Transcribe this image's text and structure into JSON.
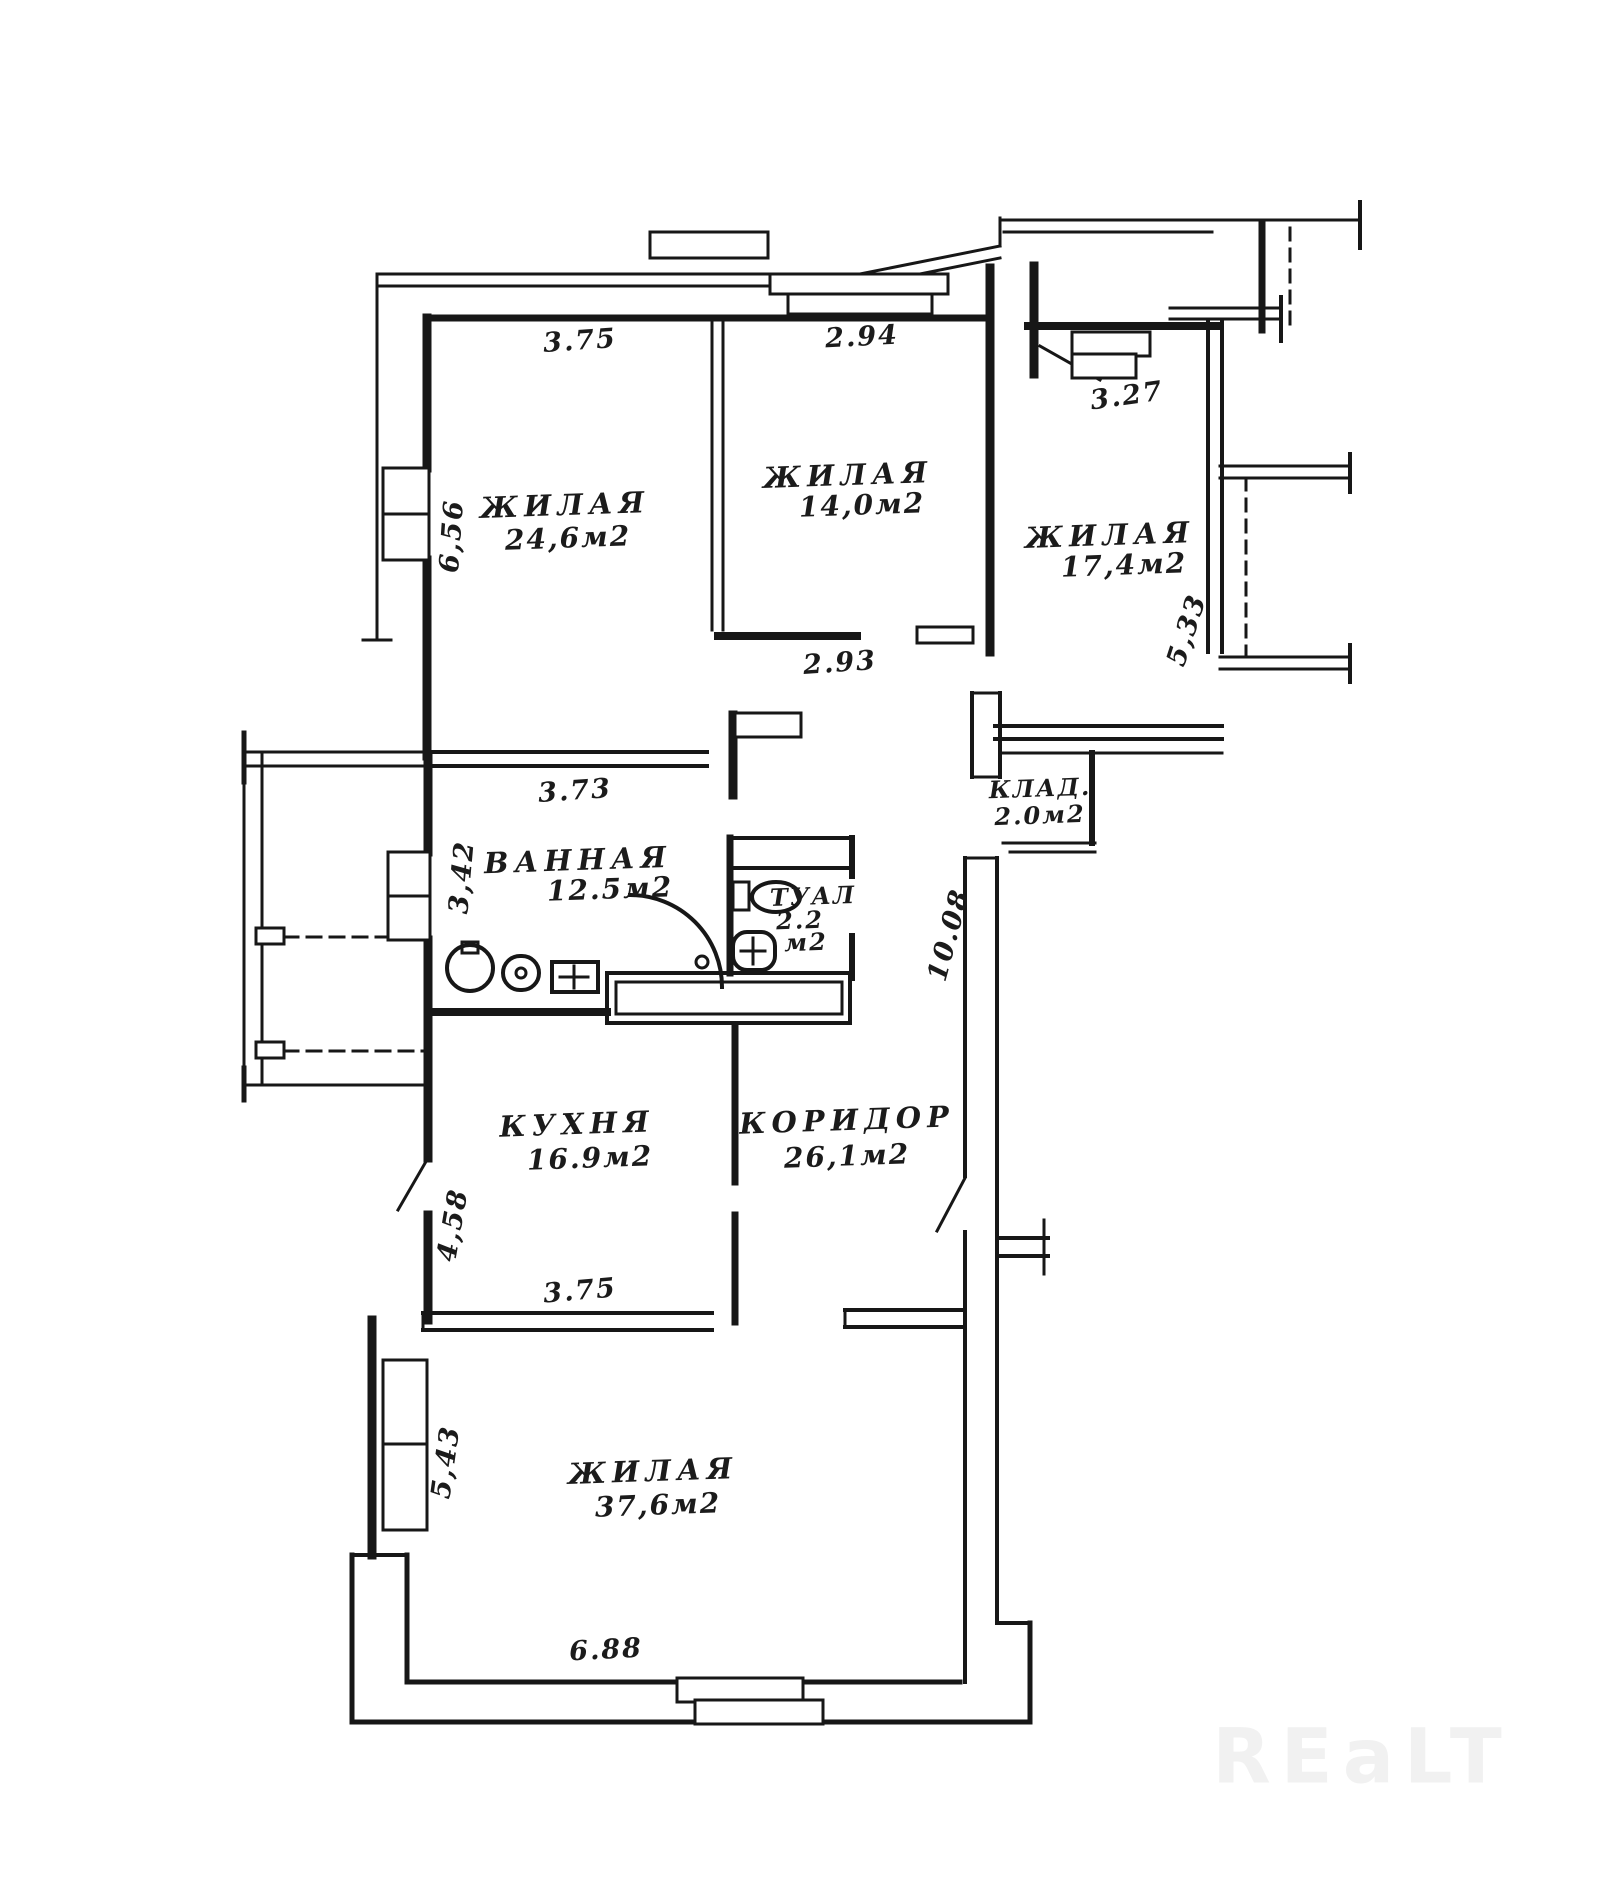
{
  "watermark": "REaLT",
  "rooms": [
    {
      "id": "living1",
      "name": "ЖИЛАЯ",
      "area": "24,6м2"
    },
    {
      "id": "living2",
      "name": "ЖИЛАЯ",
      "area": "14,0м2"
    },
    {
      "id": "living3",
      "name": "ЖИЛАЯ",
      "area": "17,4м2"
    },
    {
      "id": "bathroom",
      "name": "ВАННАЯ",
      "area": "12.5м2"
    },
    {
      "id": "toilet",
      "name": "ТУАЛ",
      "area": "2.2",
      "area_unit": "м2"
    },
    {
      "id": "storage",
      "name": "КЛАД.",
      "area": "2.0м2"
    },
    {
      "id": "kitchen",
      "name": "КУХНЯ",
      "area": "16.9м2"
    },
    {
      "id": "corridor",
      "name": "КОРИДОР",
      "area": "26,1м2"
    },
    {
      "id": "living4",
      "name": "ЖИЛАЯ",
      "area": "37,6м2"
    }
  ],
  "dimensions": [
    {
      "id": "dim-room1-top",
      "value": "3.75"
    },
    {
      "id": "dim-room2-top",
      "value": "2.94"
    },
    {
      "id": "dim-room3-top",
      "value": "3.27"
    },
    {
      "id": "dim-room1-left",
      "value": "6,56"
    },
    {
      "id": "dim-room3-right",
      "value": "5,33"
    },
    {
      "id": "dim-room2-bottom",
      "value": "2.93"
    },
    {
      "id": "dim-bath-top",
      "value": "3.73"
    },
    {
      "id": "dim-bath-left",
      "value": "3,42"
    },
    {
      "id": "dim-corridor",
      "value": "10.08"
    },
    {
      "id": "dim-kitchen-left",
      "value": "4,58"
    },
    {
      "id": "dim-room4-top",
      "value": "3.75"
    },
    {
      "id": "dim-room4-left",
      "value": "5,43"
    },
    {
      "id": "dim-room4-bottom",
      "value": "6.88"
    }
  ]
}
